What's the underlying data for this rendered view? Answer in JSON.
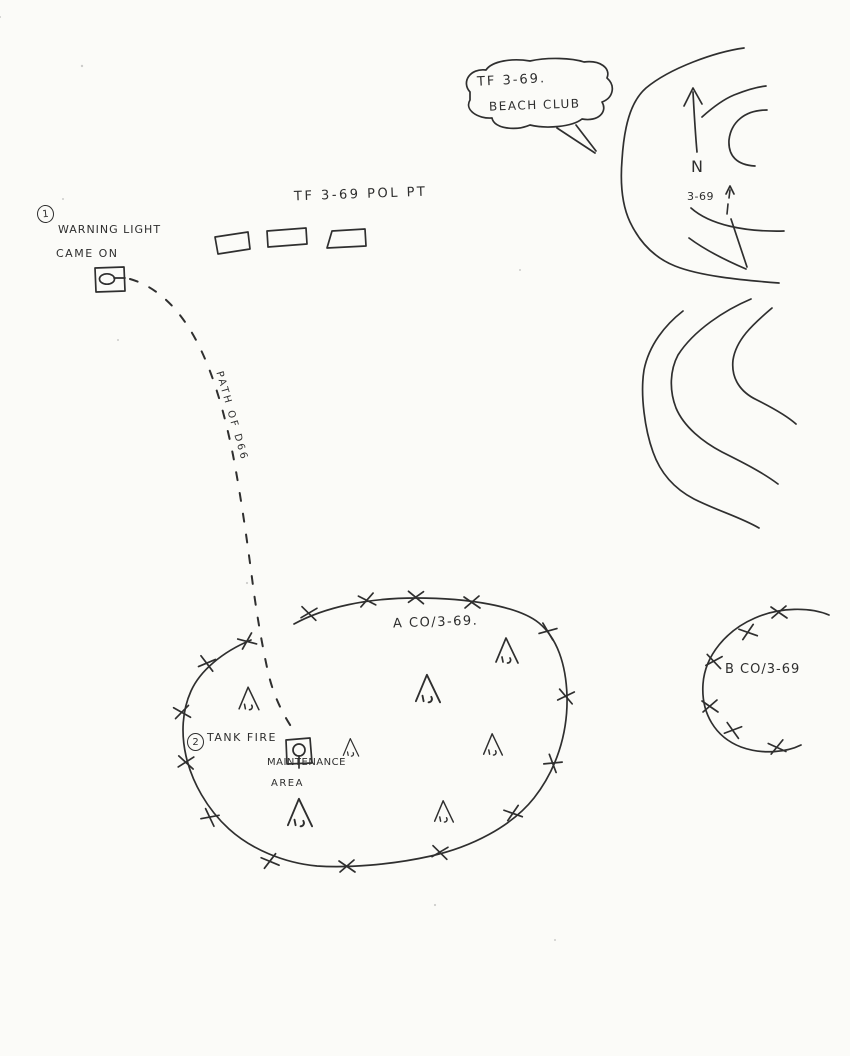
{
  "sketch": {
    "title_bubble": {
      "line1": "TF 3-69.",
      "line2": "BEACH CLUB"
    },
    "pol_point": {
      "label": "TF 3-69 POL PT"
    },
    "event1": {
      "number": "1",
      "line1": "WARNING LIGHT",
      "line2": "CAME ON"
    },
    "path_label": "PATH OF D66",
    "north": {
      "letter": "N",
      "unit": "3-69"
    },
    "alpha_company": {
      "label": "A CO/3-69."
    },
    "bravo_company": {
      "label": "B CO/3-69"
    },
    "event2": {
      "number": "2",
      "label": "TANK FIRE"
    },
    "maintenance": {
      "line1": "MAINTENANCE",
      "line2": "AREA"
    },
    "symbols": {
      "tank": "tank-icon",
      "maintenance_vehicle": "vehicle-in-maintenance-icon",
      "tent": "tent-icon",
      "perimeter_x": "obstacle-x-icon",
      "north_arrow": "north-arrow-icon",
      "fuel_pods": "pol-pad-rectangles"
    },
    "colors": {
      "ink": "#2f2f2f",
      "paper": "#fbfbf8"
    }
  }
}
